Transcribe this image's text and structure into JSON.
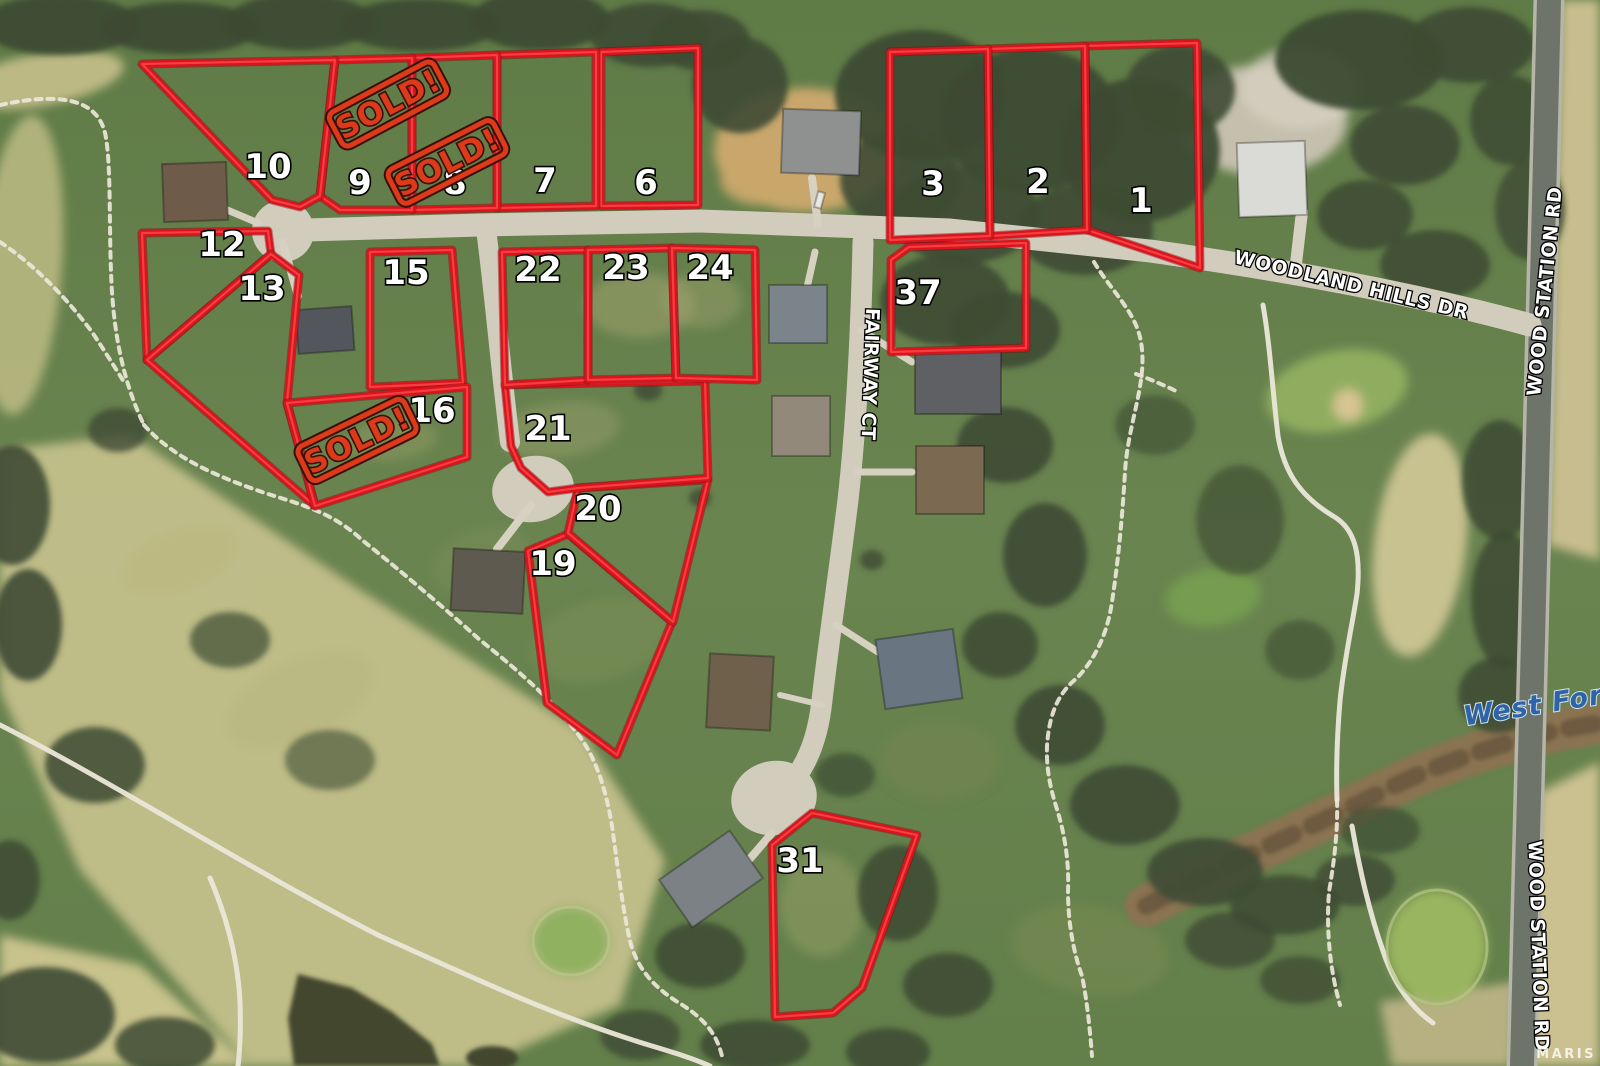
{
  "watermark": "MARIS",
  "colors": {
    "lot_line": "#d8151f",
    "lot_line_shadow": "#7e0a10",
    "lot_line_highlight": "#fb4343",
    "lot_number_fill": "#ffffff",
    "lot_number_outline": "#000000",
    "stamp_color": "#dd3a1a",
    "stamp_outline": "#38100a",
    "street_label_fill": "#ffffff",
    "water_label_color": "#2d64a8"
  },
  "streets": [
    {
      "label": "WOODLAND HILLS DR",
      "x": 1350,
      "y": 291,
      "rotation": 13.5,
      "kind": "road"
    },
    {
      "label": "FAIRWAY CT",
      "x": 864,
      "y": 374,
      "rotation": 92,
      "kind": "road"
    },
    {
      "label": "WOOD STATION RD",
      "x": 1551,
      "y": 292,
      "rotation": -84,
      "kind": "road"
    },
    {
      "label": "WOOD STATION RD",
      "x": 1532,
      "y": 946,
      "rotation": 88,
      "kind": "road"
    },
    {
      "label": "West Fork",
      "x": 1544,
      "y": 713,
      "rotation": -9,
      "kind": "water"
    }
  ],
  "sold_stamps": [
    {
      "label": "SOLD!",
      "x": 388,
      "y": 104,
      "rotation": -28
    },
    {
      "label": "SOLD!",
      "x": 447,
      "y": 162,
      "rotation": -27
    },
    {
      "label": "SOLD!",
      "x": 357,
      "y": 440,
      "rotation": -26
    }
  ],
  "lots": [
    {
      "id": "1",
      "label": "1",
      "points": "1085,46 1197,43 1200,268 1087,230",
      "label_x": 1141,
      "label_y": 212
    },
    {
      "id": "2",
      "label": "2",
      "points": "988,49 1085,46 1087,230 990,236",
      "label_x": 1038,
      "label_y": 193
    },
    {
      "id": "3",
      "label": "3",
      "points": "890,52 988,49 990,236 890,240",
      "label_x": 933,
      "label_y": 195
    },
    {
      "id": "6",
      "label": "6",
      "points": "601,52 698,48 698,205 601,206",
      "label_x": 646,
      "label_y": 194
    },
    {
      "id": "7",
      "label": "7",
      "points": "497,55 596,52 596,206 497,208",
      "label_x": 545,
      "label_y": 192
    },
    {
      "id": "8",
      "label": "8",
      "points": "412,58 497,55 497,208 412,210",
      "label_x": 455,
      "label_y": 194
    },
    {
      "id": "9",
      "label": "9",
      "points": "335,60 412,58 412,210 340,210 320,196",
      "label_x": 360,
      "label_y": 194
    },
    {
      "id": "10",
      "label": "10",
      "points": "142,64 335,60 320,196 300,207 272,200",
      "label_x": 268,
      "label_y": 178
    },
    {
      "id": "12",
      "label": "12",
      "points": "142,233 268,231 271,254 147,360",
      "label_x": 222,
      "label_y": 256
    },
    {
      "id": "13",
      "label": "13",
      "points": "271,254 147,360 315,506 287,403 299,275",
      "label_x": 262,
      "label_y": 300
    },
    {
      "id": "15",
      "label": "15",
      "points": "370,252 452,250 463,383 370,387",
      "label_x": 406,
      "label_y": 284
    },
    {
      "id": "16",
      "label": "16",
      "points": "287,403 315,506 467,457 467,387",
      "label_x": 432,
      "label_y": 422
    },
    {
      "id": "19",
      "label": "19",
      "points": "568,534 672,622 617,755 547,703 528,551",
      "label_x": 553,
      "label_y": 575
    },
    {
      "id": "20",
      "label": "20",
      "points": "578,488 708,480 673,622 568,533",
      "label_x": 598,
      "label_y": 520
    },
    {
      "id": "21",
      "label": "21",
      "points": "505,385 705,381 708,478 578,488 548,492 521,468 511,446",
      "label_x": 548,
      "label_y": 440
    },
    {
      "id": "22",
      "label": "22",
      "points": "502,252 588,250 588,380 505,385",
      "label_x": 538,
      "label_y": 281
    },
    {
      "id": "23",
      "label": "23",
      "points": "588,250 672,248 676,378 588,380",
      "label_x": 626,
      "label_y": 279
    },
    {
      "id": "24",
      "label": "24",
      "points": "672,248 755,250 757,380 676,378",
      "label_x": 710,
      "label_y": 279
    },
    {
      "id": "31",
      "label": "31",
      "points": "772,845 812,813 917,835 862,988 833,1013 775,1017",
      "label_x": 800,
      "label_y": 872
    },
    {
      "id": "37",
      "label": "37",
      "points": "909,247 1026,243 1026,348 891,352 891,260",
      "label_x": 918,
      "label_y": 304
    }
  ]
}
